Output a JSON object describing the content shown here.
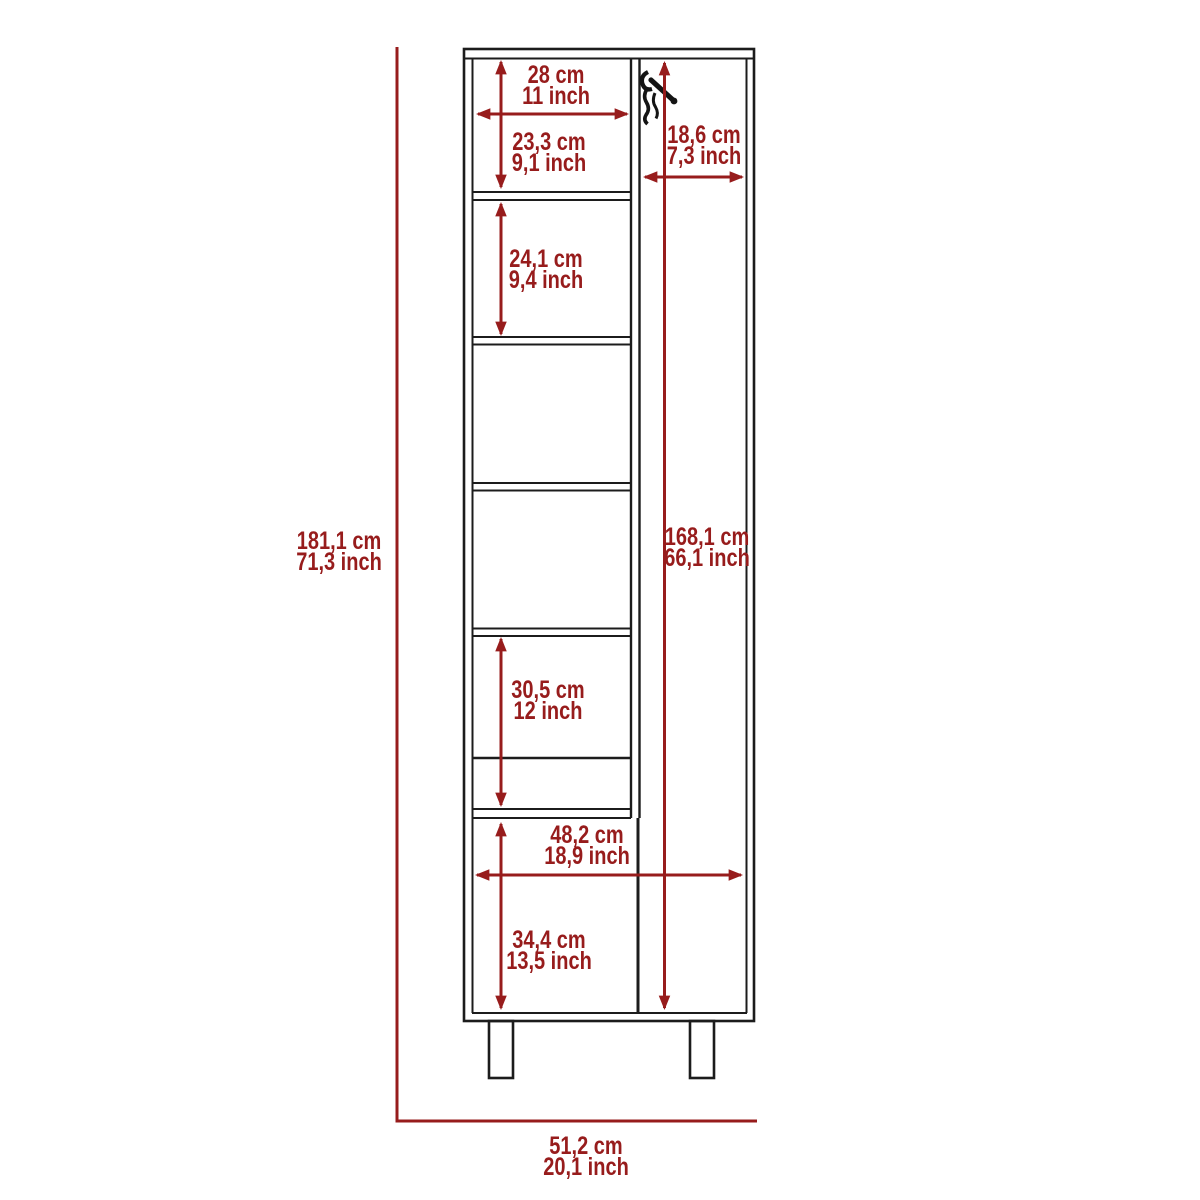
{
  "diagram": {
    "type": "furniture-dimension-diagram",
    "subject": "tall-broom-cabinet-with-shelves",
    "units": [
      "cm",
      "inch"
    ],
    "colors": {
      "dimension": "#971c1c",
      "outline": "#1c1c1c",
      "background": "#ffffff"
    },
    "dimensions": {
      "overall_height": {
        "cm": "181,1 cm",
        "inch": "71,3 inch"
      },
      "overall_width": {
        "cm": "51,2 cm",
        "inch": "20,1 inch"
      },
      "top_compartment_width": {
        "cm": "28 cm",
        "inch": "11 inch"
      },
      "top_compartment_height": {
        "cm": "23,3 cm",
        "inch": "9,1 inch"
      },
      "second_compartment_height": {
        "cm": "24,1 cm",
        "inch": "9,4 inch"
      },
      "broom_side_width": {
        "cm": "18,6 cm",
        "inch": "7,3 inch"
      },
      "broom_side_height": {
        "cm": "168,1 cm",
        "inch": "66,1 inch"
      },
      "lower_compartment_height": {
        "cm": "30,5 cm",
        "inch": "12 inch"
      },
      "interior_width": {
        "cm": "48,2 cm",
        "inch": "18,9 inch"
      },
      "bottom_door_height": {
        "cm": "34,4 cm",
        "inch": "13,5 inch"
      }
    }
  }
}
